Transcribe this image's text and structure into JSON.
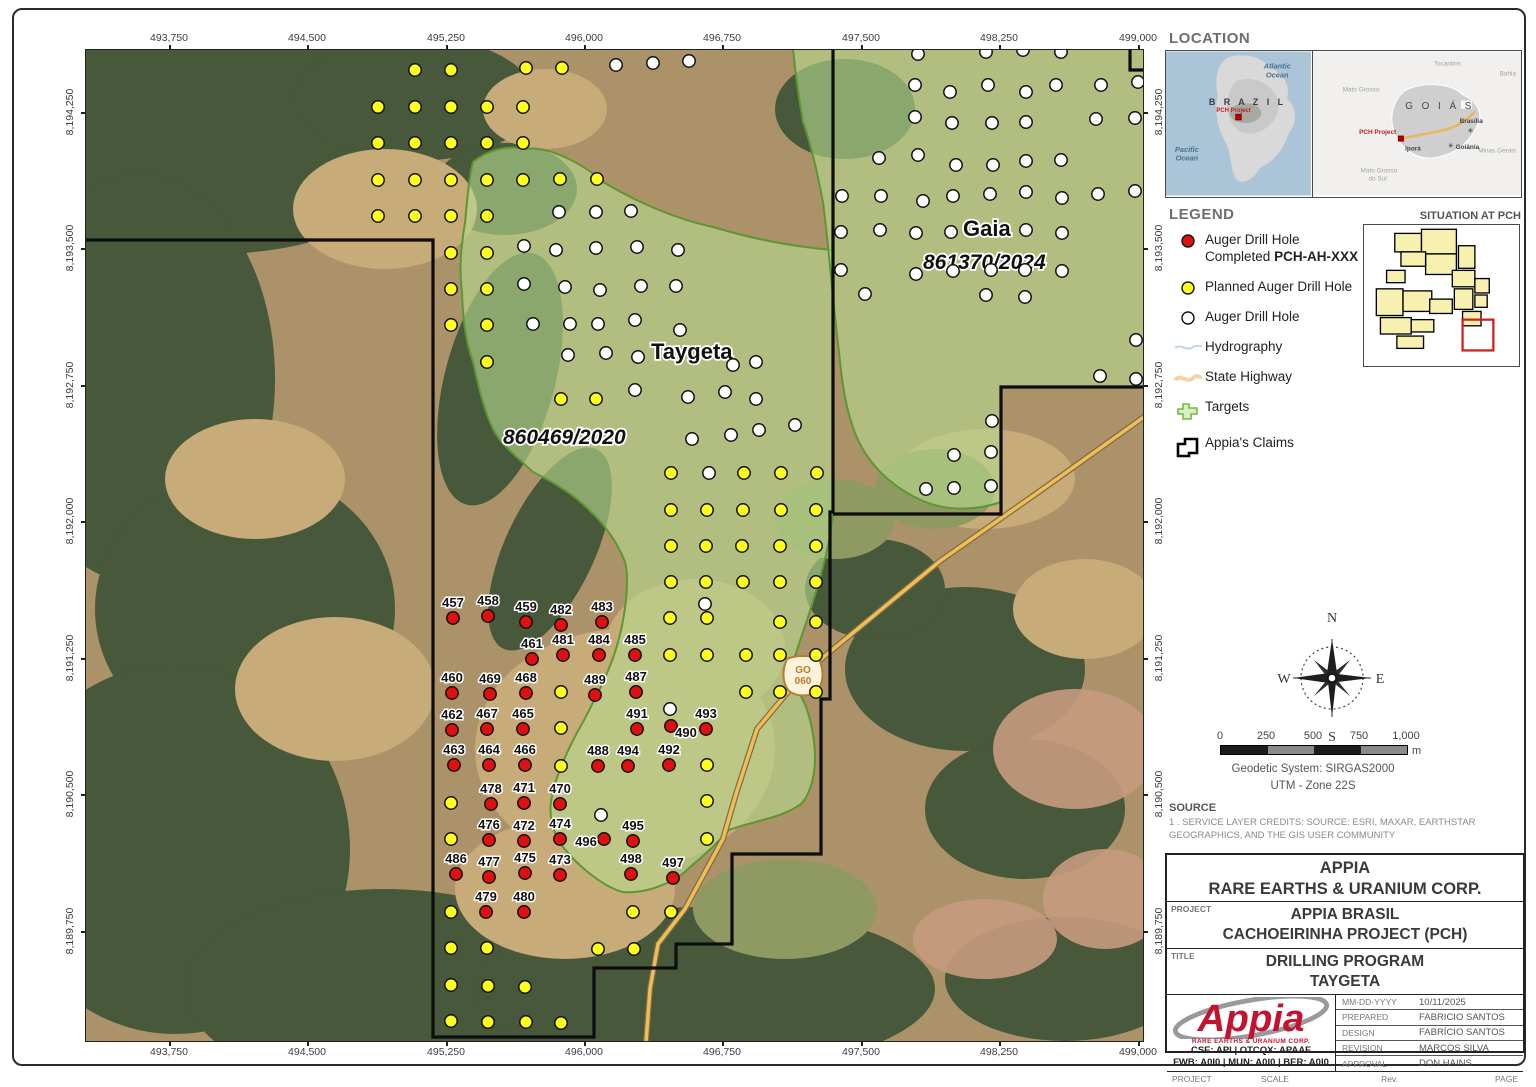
{
  "map": {
    "taygeta_label": "Taygeta",
    "taygeta_license": "860469/2020",
    "gaia_label": "Gaia",
    "gaia_license": "861370/2024",
    "shield_line1": "GO",
    "shield_line2": "060",
    "top_coords": [
      "493,750",
      "494,500",
      "495,250",
      "496,000",
      "496,750",
      "497,500",
      "498,250",
      "499,000"
    ],
    "bottom_coords": [
      "493,750",
      "494,500",
      "495,250",
      "496,000",
      "496,750",
      "497,500",
      "498,250",
      "499,000"
    ],
    "left_coords": [
      "8,194,250",
      "8,193,500",
      "8,192,750",
      "8,192,000",
      "8,191,250",
      "8,190,500",
      "8,189,750"
    ],
    "right_coords": [
      "8,194,250",
      "8,193,500",
      "8,192,750",
      "8,192,000",
      "8,191,250",
      "8,190,500",
      "8,189,750"
    ],
    "colors": {
      "completed": "#e01010",
      "planned": "#ffff1e",
      "auger": "#ffffff",
      "target_fill": "#b8dc8f",
      "target_edge": "#5d9732",
      "claims": "#0d0d0d",
      "highway": "#f2bd55"
    },
    "drill_holes": {
      "completed_labeled": [
        {
          "label": "457",
          "x": 368,
          "y": 569
        },
        {
          "label": "458",
          "x": 403,
          "y": 567
        },
        {
          "label": "459",
          "x": 441,
          "y": 573
        },
        {
          "label": "482",
          "x": 476,
          "y": 576
        },
        {
          "label": "483",
          "x": 517,
          "y": 573
        },
        {
          "label": "461",
          "x": 447,
          "y": 610
        },
        {
          "label": "481",
          "x": 478,
          "y": 606
        },
        {
          "label": "484",
          "x": 514,
          "y": 606
        },
        {
          "label": "485",
          "x": 550,
          "y": 606
        },
        {
          "label": "460",
          "x": 367,
          "y": 644
        },
        {
          "label": "469",
          "x": 405,
          "y": 645
        },
        {
          "label": "468",
          "x": 441,
          "y": 644
        },
        {
          "label": "489",
          "x": 510,
          "y": 646
        },
        {
          "label": "487",
          "x": 551,
          "y": 643
        },
        {
          "label": "462",
          "x": 367,
          "y": 681
        },
        {
          "label": "467",
          "x": 402,
          "y": 680
        },
        {
          "label": "465",
          "x": 438,
          "y": 680
        },
        {
          "label": "491",
          "x": 552,
          "y": 680
        },
        {
          "label": "490",
          "x": 586,
          "y": 677,
          "lx": 15,
          "ly": 22
        },
        {
          "label": "493",
          "x": 621,
          "y": 680
        },
        {
          "label": "463",
          "x": 369,
          "y": 716
        },
        {
          "label": "464",
          "x": 404,
          "y": 716
        },
        {
          "label": "466",
          "x": 440,
          "y": 716
        },
        {
          "label": "488",
          "x": 513,
          "y": 717
        },
        {
          "label": "494",
          "x": 543,
          "y": 717
        },
        {
          "label": "492",
          "x": 584,
          "y": 716
        },
        {
          "label": "478",
          "x": 406,
          "y": 755
        },
        {
          "label": "471",
          "x": 439,
          "y": 754
        },
        {
          "label": "470",
          "x": 475,
          "y": 755
        },
        {
          "label": "476",
          "x": 404,
          "y": 791
        },
        {
          "label": "472",
          "x": 439,
          "y": 792
        },
        {
          "label": "474",
          "x": 475,
          "y": 790
        },
        {
          "label": "496",
          "x": 519,
          "y": 790,
          "lx": -18,
          "ly": 18
        },
        {
          "label": "495",
          "x": 548,
          "y": 792
        },
        {
          "label": "486",
          "x": 371,
          "y": 825
        },
        {
          "label": "477",
          "x": 404,
          "y": 828
        },
        {
          "label": "475",
          "x": 440,
          "y": 824
        },
        {
          "label": "473",
          "x": 475,
          "y": 826
        },
        {
          "label": "498",
          "x": 546,
          "y": 825
        },
        {
          "label": "497",
          "x": 588,
          "y": 829
        },
        {
          "label": "479",
          "x": 401,
          "y": 863
        },
        {
          "label": "480",
          "x": 439,
          "y": 863
        }
      ],
      "planned": [
        [
          330,
          21
        ],
        [
          366,
          21
        ],
        [
          441,
          19
        ],
        [
          477,
          19
        ],
        [
          293,
          58
        ],
        [
          330,
          58
        ],
        [
          366,
          58
        ],
        [
          402,
          58
        ],
        [
          438,
          58
        ],
        [
          293,
          94
        ],
        [
          330,
          94
        ],
        [
          366,
          94
        ],
        [
          402,
          94
        ],
        [
          438,
          94
        ],
        [
          293,
          131
        ],
        [
          330,
          131
        ],
        [
          366,
          131
        ],
        [
          402,
          131
        ],
        [
          438,
          131
        ],
        [
          475,
          130
        ],
        [
          512,
          130
        ],
        [
          293,
          167
        ],
        [
          330,
          167
        ],
        [
          366,
          167
        ],
        [
          402,
          167
        ],
        [
          366,
          204
        ],
        [
          402,
          204
        ],
        [
          366,
          240
        ],
        [
          402,
          240
        ],
        [
          366,
          276
        ],
        [
          402,
          276
        ],
        [
          402,
          313
        ],
        [
          476,
          350
        ],
        [
          511,
          350
        ],
        [
          586,
          424
        ],
        [
          659,
          424
        ],
        [
          696,
          424
        ],
        [
          732,
          424
        ],
        [
          586,
          461
        ],
        [
          622,
          461
        ],
        [
          658,
          461
        ],
        [
          696,
          461
        ],
        [
          731,
          461
        ],
        [
          586,
          497
        ],
        [
          621,
          497
        ],
        [
          657,
          497
        ],
        [
          695,
          497
        ],
        [
          731,
          497
        ],
        [
          586,
          533
        ],
        [
          621,
          533
        ],
        [
          658,
          533
        ],
        [
          695,
          533
        ],
        [
          731,
          533
        ],
        [
          585,
          569
        ],
        [
          622,
          569
        ],
        [
          695,
          573
        ],
        [
          731,
          573
        ],
        [
          585,
          606
        ],
        [
          622,
          606
        ],
        [
          661,
          606
        ],
        [
          695,
          606
        ],
        [
          731,
          606
        ],
        [
          476,
          643
        ],
        [
          661,
          643
        ],
        [
          695,
          643
        ],
        [
          731,
          643
        ],
        [
          476,
          679
        ],
        [
          476,
          717
        ],
        [
          622,
          716
        ],
        [
          366,
          754
        ],
        [
          622,
          752
        ],
        [
          366,
          790
        ],
        [
          622,
          790
        ],
        [
          366,
          863
        ],
        [
          548,
          863
        ],
        [
          586,
          863
        ],
        [
          366,
          899
        ],
        [
          402,
          899
        ],
        [
          513,
          900
        ],
        [
          549,
          900
        ],
        [
          366,
          936
        ],
        [
          403,
          937
        ],
        [
          440,
          938
        ],
        [
          366,
          972
        ],
        [
          403,
          973
        ],
        [
          441,
          973
        ],
        [
          476,
          974
        ]
      ],
      "auger": [
        [
          531,
          16
        ],
        [
          568,
          14
        ],
        [
          604,
          12
        ],
        [
          474,
          163
        ],
        [
          511,
          163
        ],
        [
          546,
          162
        ],
        [
          439,
          197
        ],
        [
          471,
          201
        ],
        [
          511,
          199
        ],
        [
          552,
          198
        ],
        [
          593,
          201
        ],
        [
          439,
          235
        ],
        [
          480,
          238
        ],
        [
          515,
          241
        ],
        [
          556,
          237
        ],
        [
          591,
          237
        ],
        [
          448,
          275
        ],
        [
          485,
          275
        ],
        [
          513,
          275
        ],
        [
          550,
          271
        ],
        [
          595,
          281
        ],
        [
          648,
          316
        ],
        [
          671,
          313
        ],
        [
          483,
          306
        ],
        [
          521,
          304
        ],
        [
          553,
          308
        ],
        [
          550,
          341
        ],
        [
          603,
          348
        ],
        [
          640,
          343
        ],
        [
          671,
          350
        ],
        [
          607,
          390
        ],
        [
          646,
          386
        ],
        [
          674,
          381
        ],
        [
          710,
          376
        ],
        [
          624,
          424
        ],
        [
          620,
          555
        ],
        [
          585,
          660
        ],
        [
          516,
          766
        ],
        [
          833,
          5
        ],
        [
          901,
          3
        ],
        [
          938,
          1
        ],
        [
          976,
          3
        ],
        [
          830,
          36
        ],
        [
          865,
          43
        ],
        [
          903,
          36
        ],
        [
          941,
          43
        ],
        [
          971,
          36
        ],
        [
          1016,
          36
        ],
        [
          1053,
          33
        ],
        [
          830,
          68
        ],
        [
          867,
          74
        ],
        [
          907,
          74
        ],
        [
          941,
          73
        ],
        [
          1011,
          70
        ],
        [
          1050,
          69
        ],
        [
          794,
          109
        ],
        [
          833,
          106
        ],
        [
          871,
          116
        ],
        [
          908,
          116
        ],
        [
          941,
          112
        ],
        [
          976,
          111
        ],
        [
          757,
          147
        ],
        [
          796,
          147
        ],
        [
          838,
          152
        ],
        [
          868,
          147
        ],
        [
          905,
          145
        ],
        [
          941,
          143
        ],
        [
          977,
          149
        ],
        [
          1013,
          145
        ],
        [
          1050,
          142
        ],
        [
          756,
          183
        ],
        [
          795,
          181
        ],
        [
          831,
          184
        ],
        [
          866,
          183
        ],
        [
          941,
          181
        ],
        [
          977,
          184
        ],
        [
          756,
          221
        ],
        [
          831,
          225
        ],
        [
          868,
          222
        ],
        [
          906,
          221
        ],
        [
          940,
          221
        ],
        [
          977,
          222
        ],
        [
          780,
          245
        ],
        [
          901,
          246
        ],
        [
          940,
          248
        ],
        [
          1051,
          291
        ],
        [
          1015,
          327
        ],
        [
          1051,
          330
        ],
        [
          907,
          372
        ],
        [
          869,
          406
        ],
        [
          906,
          403
        ],
        [
          841,
          440
        ],
        [
          869,
          439
        ],
        [
          906,
          437
        ]
      ]
    }
  },
  "location_panel": {
    "header": "LOCATION",
    "brazil": {
      "country": "B R A Z I L",
      "ocean1a": "Atlantic",
      "ocean1b": "Ocean",
      "ocean2a": "Pacific",
      "ocean2b": "Ocean",
      "project": "PCH Project"
    },
    "goias": {
      "state": "G O I Á S",
      "n1": "Mato Grosso",
      "n2": "Tocantins",
      "n3": "Bahia",
      "n4": "Minas Gerais",
      "n5a": "Mato Grosso",
      "n5b": "do Sul",
      "project": "PCH Project",
      "town1": "Iporá",
      "town2": "Goiânia",
      "town3": "Brasília"
    }
  },
  "legend": {
    "header": "LEGEND",
    "items": [
      {
        "label": "Auger Drill Hole Completed",
        "bold": "PCH-AH-XXX"
      },
      {
        "label": "Planned Auger Drill Hole"
      },
      {
        "label": "Auger Drill Hole"
      },
      {
        "label": "Hydrography"
      },
      {
        "label": "State Highway"
      },
      {
        "label": "Targets"
      },
      {
        "label": "Appia's Claims"
      }
    ]
  },
  "situation": {
    "header": "SITUATION AT PCH"
  },
  "compass": {
    "n": "N",
    "s": "S",
    "e": "E",
    "w": "W"
  },
  "scalebar": {
    "ticks": [
      "0",
      "250",
      "500",
      "750",
      "1,000"
    ],
    "unit": "m",
    "crs1": "Geodetic System: SIRGAS2000",
    "crs2": "UTM - Zone 22S"
  },
  "source": {
    "header": "SOURCE",
    "line1": "1 . SERVICE LAYER CREDITS: SOURCE: ESRI, MAXAR, EARTHSTAR",
    "line2": "GEOGRAPHICS, AND THE GIS USER COMMUNITY"
  },
  "titleblock": {
    "company_line1": "APPIA",
    "company_line2": "RARE EARTHS & URANIUM CORP.",
    "project_label": "PROJECT",
    "project_line1": "APPIA BRASIL",
    "project_line2": "CACHOEIRINHA PROJECT (PCH)",
    "title_label": "TITLE",
    "title_line1": "DRILLING PROGRAM",
    "title_line2": "TAYGETA",
    "logo_text": "Appia",
    "logo_sub": "RARE EARTHS & URANIUM CORP.",
    "logo_tickers1": "CSE: API  |  OTCQX: APAAF",
    "logo_tickers2": "FWB: A0I0  |  MUN: A0I0  |  BER: A0I0",
    "info_rows": [
      {
        "label": "MM-DD-YYYY",
        "value": "10/11/2025"
      },
      {
        "label": "PREPARED",
        "value": "FABRICIO SANTOS"
      },
      {
        "label": "DESIGN",
        "value": "FABRÍCIO SANTOS"
      },
      {
        "label": "REVISION",
        "value": "MARCOS SILVA"
      },
      {
        "label": "APPROVAL",
        "value": "DON HAINS"
      }
    ],
    "footer": {
      "project_label": "PROJECT",
      "project_value": "PCH",
      "scale_label": "SCALE",
      "scale_value": "1:20,000",
      "rev_label": "Rev.",
      "rev_value": "0",
      "page_label": "PAGE",
      "page_value": "A3"
    }
  }
}
